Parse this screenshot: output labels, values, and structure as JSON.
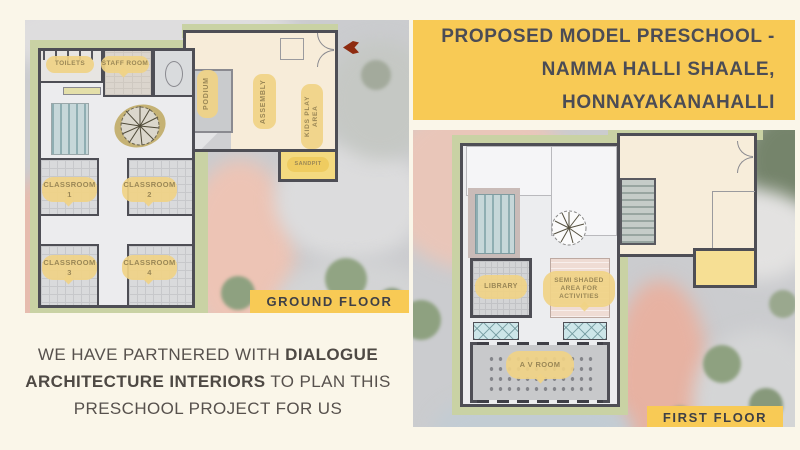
{
  "title": {
    "line1": "PROPOSED MODEL PRESCHOOL -",
    "line2": "NAMMA HALLI SHAALE,",
    "line3": "HONNAYAKANAHALLI"
  },
  "partner": {
    "lines": [
      [
        {
          "t": "WE HAVE PARTNERED WITH ",
          "b": false
        },
        {
          "t": "DIALOGUE",
          "b": true
        }
      ],
      [
        {
          "t": "ARCHITECTURE INTERIORS",
          "b": true
        },
        {
          "t": " TO PLAN THIS",
          "b": false
        }
      ],
      [
        {
          "t": "PRESCHOOL PROJECT FOR US",
          "b": false
        }
      ]
    ]
  },
  "ground_floor": {
    "tag": "GROUND FLOOR",
    "rooms": {
      "toilets": "TOILETS",
      "staff_room": "STAFF ROOM",
      "podium": "PODIUM",
      "assembly": "ASSEMBLY",
      "kids_play_area": "KIDS PLAY AREA",
      "sandpit": "SANDPIT",
      "classroom1": "CLASSROOM 1",
      "classroom2": "CLASSROOM 2",
      "classroom3": "CLASSROOM 3",
      "classroom4": "CLASSROOM 4"
    }
  },
  "first_floor": {
    "tag": "FIRST FLOOR",
    "rooms": {
      "library": "LIBRARY",
      "semi_shaded": "SEMI SHADED AREA FOR ACTIVITIES",
      "av_room": "A V ROOM"
    }
  },
  "icons": {
    "entrance_arrow": "entrance-arrow-icon",
    "tree": "tree-icon"
  },
  "colors": {
    "accent_yellow": "#F8CA55",
    "label_yellow": "#F0D385",
    "title_text": "#4B4C55",
    "body_text": "#57514D",
    "entrance_arrow": "#8E2B10",
    "landscape_green": "#C9D2A4",
    "wall": "#4E4E55"
  }
}
